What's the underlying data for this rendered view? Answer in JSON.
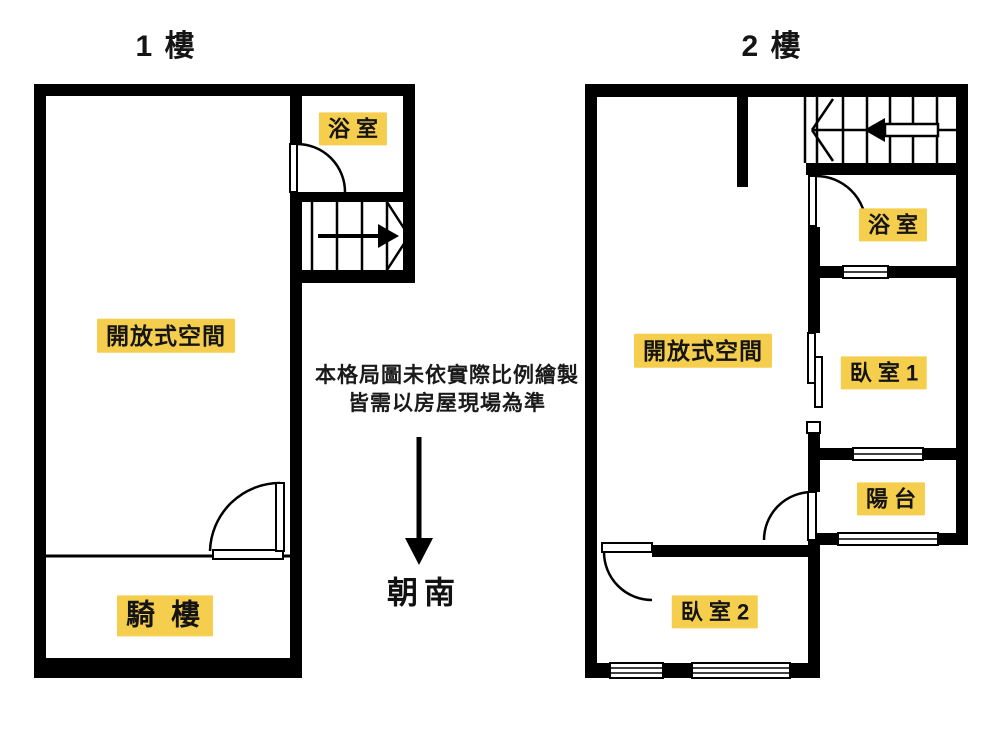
{
  "page": {
    "background": "#ffffff"
  },
  "colors": {
    "wall": "#000000",
    "label_bg": "#F6CE4E",
    "text": "#111111"
  },
  "floor1": {
    "title": "1 樓",
    "rooms": {
      "bathroom": "浴 室",
      "open_space": "開放式空間",
      "arcade": "騎 樓"
    }
  },
  "floor2": {
    "title": "2 樓",
    "rooms": {
      "bathroom": "浴 室",
      "open_space": "開放式空間",
      "bedroom1": "臥 室 1",
      "balcony": "陽 台",
      "bedroom2": "臥 室 2"
    }
  },
  "disclaimer": {
    "line1": "本格局圖未依實際比例繪製",
    "line2": "皆需以房屋現場為準"
  },
  "orientation": {
    "label": "朝南",
    "direction": "south"
  }
}
